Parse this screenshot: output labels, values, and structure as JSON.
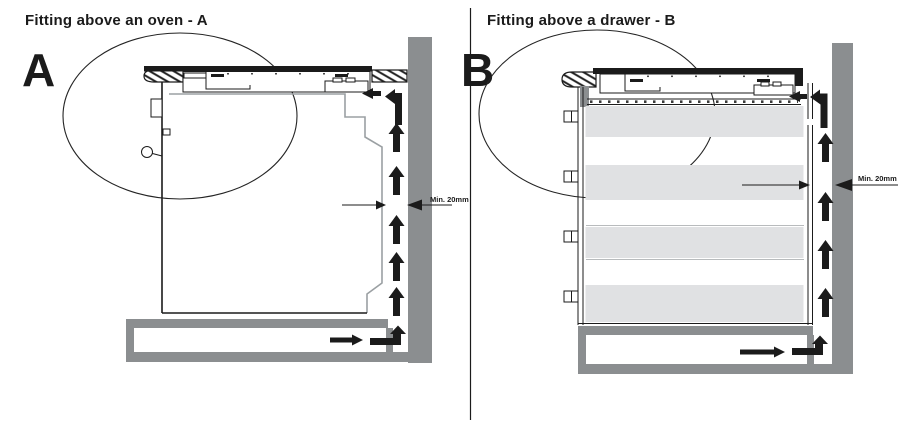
{
  "figure": {
    "type": "hob-installation-diagram",
    "panels": [
      {
        "id": "A",
        "title": "Fitting above an oven - A",
        "letter": "A",
        "min_gap_label": "Min. 20mm"
      },
      {
        "id": "B",
        "title": "Fitting above a drawer - B",
        "letter": "B",
        "min_gap_label": "Min. 20mm"
      }
    ]
  },
  "colors": {
    "line_black": "#1b1b1b",
    "wall_gray": "#8b8e90",
    "plinth_gray": "#8b8e90",
    "drawer_gray": "#e0e1e3",
    "outline_gray": "#9ba0a3",
    "background": "#ffffff"
  }
}
